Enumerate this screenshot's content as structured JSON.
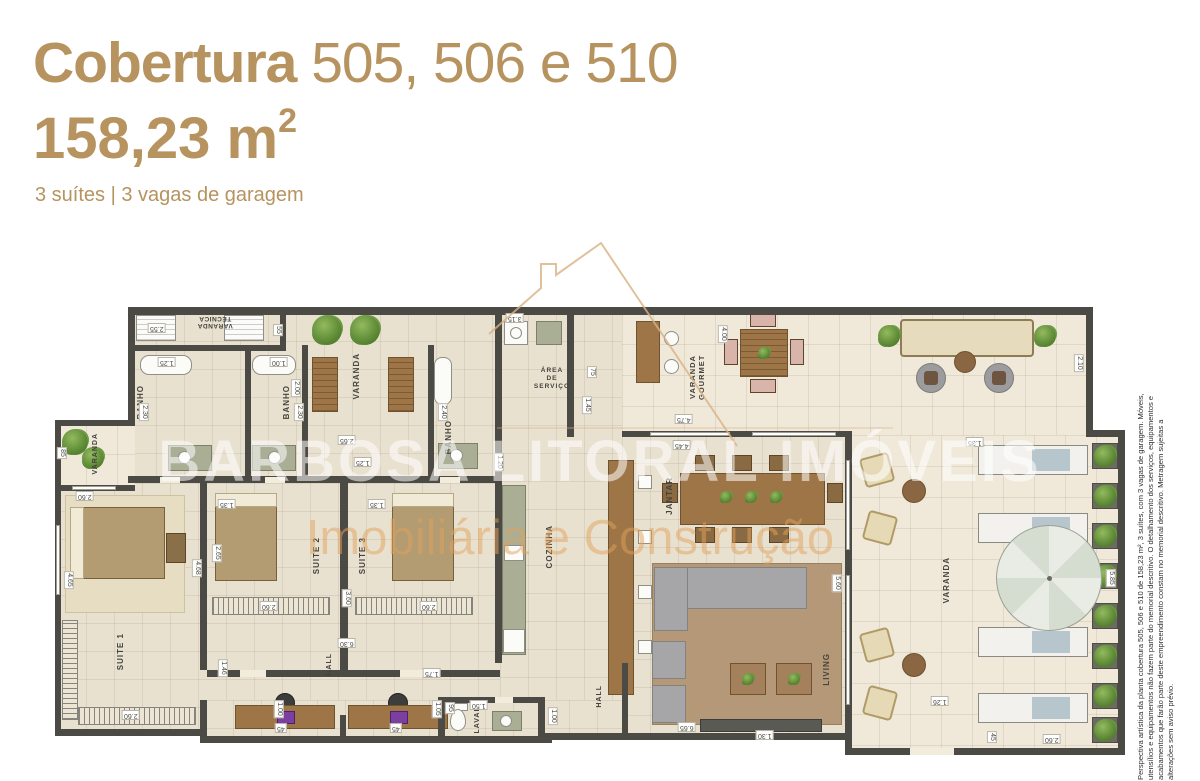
{
  "header": {
    "title_bold": "Cobertura",
    "title_rest": " 505, 506 e 510",
    "area_value": "158,23 m",
    "area_exp": "2",
    "subtitle": "3 suítes | 3 vagas de garagem",
    "accent_color": "#b6935f"
  },
  "watermark": {
    "line1": "BARBOSA LITORAL IMÓVEIS",
    "line2": "Imobiliária e Construção"
  },
  "disclaimer": "Perspectiva artística da planta cobertura 505, 506 e 510 de 158,23 m², 3 suítes, com 3 vagas de garagem. Móveis, utensílios e equipamentos não fazem parte do memorial descritivo. O detalhamento dos serviços, equipamentos e acabamentos que farão parte deste empreendimento constam no memorial descritivo. Metragem sujeitas a alterações sem aviso prévio.",
  "plan": {
    "rooms": {
      "varanda_tecnica": "VARANDA\nTÉCNICA",
      "banho1": "BANHO",
      "banho2": "BANHO",
      "banho3": "BANHO",
      "varanda_top": "VARANDA",
      "varanda_left": "VARANDA",
      "varanda_right": "VARANDA",
      "area_servico": "ÁREA\nDE\nSERVIÇO",
      "cozinha": "COZINHA",
      "varanda_gourmet": "VARANDA GOURMET",
      "jantar": "JANTAR",
      "living": "LIVING",
      "suite1": "SUITE 1",
      "suite2": "SUITE 2",
      "suite3": "SUITE 3",
      "hall1": "HALL",
      "hall2": "HALL",
      "lavabo": "LAVABO"
    },
    "colors": {
      "wall": "#4c4a44",
      "floor": "#e9e1d0",
      "terrace_floor": "#f0e9da"
    },
    "dimensions": [
      {
        "v": "2.55",
        "x": 108,
        "y": 78,
        "r": 180
      },
      {
        "v": "55",
        "x": 232,
        "y": 80,
        "r": 90
      },
      {
        "v": "1.25",
        "x": 118,
        "y": 112,
        "r": 180
      },
      {
        "v": "1.00",
        "x": 230,
        "y": 112,
        "r": 180
      },
      {
        "v": "2.30",
        "x": 95,
        "y": 162,
        "r": 90
      },
      {
        "v": "2.30",
        "x": 250,
        "y": 162,
        "r": 90
      },
      {
        "v": "2.00",
        "x": 247,
        "y": 138,
        "r": 90
      },
      {
        "v": "2.40",
        "x": 394,
        "y": 162,
        "r": 90
      },
      {
        "v": "2.65",
        "x": 298,
        "y": 190,
        "r": 180
      },
      {
        "v": "1.25",
        "x": 314,
        "y": 212,
        "r": 180
      },
      {
        "v": "3.15",
        "x": 466,
        "y": 68,
        "r": 180
      },
      {
        "v": "75",
        "x": 546,
        "y": 122,
        "r": 90
      },
      {
        "v": "1.45",
        "x": 538,
        "y": 155,
        "r": 90
      },
      {
        "v": "1.20",
        "x": 450,
        "y": 212,
        "r": 90
      },
      {
        "v": "85",
        "x": 16,
        "y": 203,
        "r": 90
      },
      {
        "v": "2.60",
        "x": 36,
        "y": 246,
        "r": 180
      },
      {
        "v": "4.65",
        "x": 20,
        "y": 330,
        "r": 90
      },
      {
        "v": "4.68",
        "x": 148,
        "y": 318,
        "r": 90
      },
      {
        "v": "2.60",
        "x": 82,
        "y": 465,
        "r": 180
      },
      {
        "v": "1.35",
        "x": 178,
        "y": 254,
        "r": 180
      },
      {
        "v": "2.65",
        "x": 168,
        "y": 303,
        "r": 90
      },
      {
        "v": "2.60",
        "x": 220,
        "y": 356,
        "r": 180
      },
      {
        "v": "3.60",
        "x": 298,
        "y": 348,
        "r": 90
      },
      {
        "v": "6.30",
        "x": 298,
        "y": 393,
        "r": 180
      },
      {
        "v": "1.35",
        "x": 328,
        "y": 254,
        "r": 180
      },
      {
        "v": "2.60",
        "x": 380,
        "y": 356,
        "r": 180
      },
      {
        "v": "1.46",
        "x": 174,
        "y": 418,
        "r": 90
      },
      {
        "v": "1.00",
        "x": 230,
        "y": 459,
        "r": 90
      },
      {
        "v": "45",
        "x": 235,
        "y": 478,
        "r": 180
      },
      {
        "v": "45",
        "x": 350,
        "y": 478,
        "r": 180
      },
      {
        "v": "1.05",
        "x": 388,
        "y": 459,
        "r": 90
      },
      {
        "v": "1.75",
        "x": 383,
        "y": 423,
        "r": 180
      },
      {
        "v": "95",
        "x": 404,
        "y": 458,
        "r": 90
      },
      {
        "v": "1.50",
        "x": 430,
        "y": 455,
        "r": 180
      },
      {
        "v": "1.00",
        "x": 504,
        "y": 466,
        "r": 90
      },
      {
        "v": "4.00",
        "x": 674,
        "y": 84,
        "r": 90
      },
      {
        "v": "4.75",
        "x": 635,
        "y": 169,
        "r": 180
      },
      {
        "v": "4.45",
        "x": 633,
        "y": 195,
        "r": 180
      },
      {
        "v": "2.10",
        "x": 1030,
        "y": 113,
        "r": 90
      },
      {
        "v": "1.35",
        "x": 926,
        "y": 192,
        "r": 180
      },
      {
        "v": "5.60",
        "x": 788,
        "y": 333,
        "r": 90
      },
      {
        "v": "6.65",
        "x": 638,
        "y": 477,
        "r": 180
      },
      {
        "v": "1.30",
        "x": 716,
        "y": 485,
        "r": 180
      },
      {
        "v": "1.26",
        "x": 891,
        "y": 451,
        "r": 180
      },
      {
        "v": "45",
        "x": 946,
        "y": 487,
        "r": 90
      },
      {
        "v": "2.60",
        "x": 1003,
        "y": 489,
        "r": 180
      },
      {
        "v": "5.85",
        "x": 1062,
        "y": 328,
        "r": 90
      }
    ]
  }
}
